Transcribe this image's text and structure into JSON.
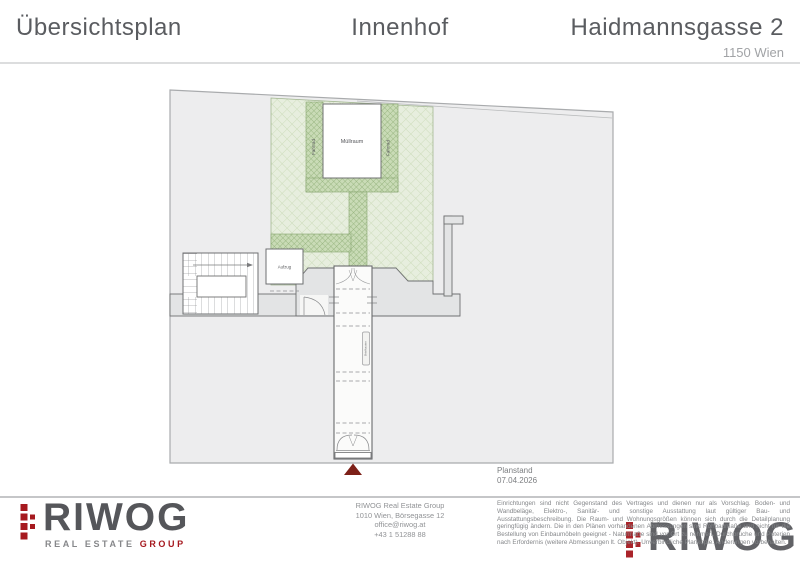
{
  "header": {
    "title_left": "Übersichtsplan",
    "title_center": "Innenhof",
    "title_right": "Haidmannsgasse 2",
    "subtitle_right": "1150 Wien"
  },
  "plan": {
    "labels": {
      "muellraum": "Müllraum",
      "fahrrad_left": "Fahrrad",
      "fahrrad_right": "Fahrrad",
      "aufzug": "Aufzug",
      "briefkasten": "Briefkasten"
    },
    "colors": {
      "site_fill": "#ededee",
      "courtyard_green": "#e7eede",
      "path_green": "#c9dbb6",
      "marker_red": "#7d2018"
    }
  },
  "footer": {
    "brand": {
      "word": "RIWOG",
      "tagline": "REAL ESTATE",
      "tagline_accent": "GROUP"
    },
    "contact": [
      "RIWOG Real Estate Group",
      "1010 Wien, Börsegasse 12",
      "office@riwog.at",
      "+43 1 51288 88"
    ],
    "planstand": {
      "label": "Planstand",
      "date": "07.04.2026"
    },
    "disclaimer": "Einrichtungen sind nicht Gegenstand des Vertrages und dienen nur als Vorschlag. Boden- und Wandbeläge, Elektro-, Sanitär- und sonstige Ausstattung laut gültiger Bau- und Ausstattungsbeschreibung. Die Raum- und Wohnungsgrößen können sich durch die Detailplanung geringfügig ändern. Die in den Plänen vorhandenen Abmessungen sind Rohbaumaße und nicht für die Bestellung von Einbaumöbeln geeignet - Naturmaße sind vor Ort zu nehmen. Durchbrüche und Poterien nach Erfordernis (weitere Abmessungen lt. Objekt). Unverbindliche Plankopie. Änderungen vorbehalten.",
    "watermark_word": "RIWOG"
  }
}
